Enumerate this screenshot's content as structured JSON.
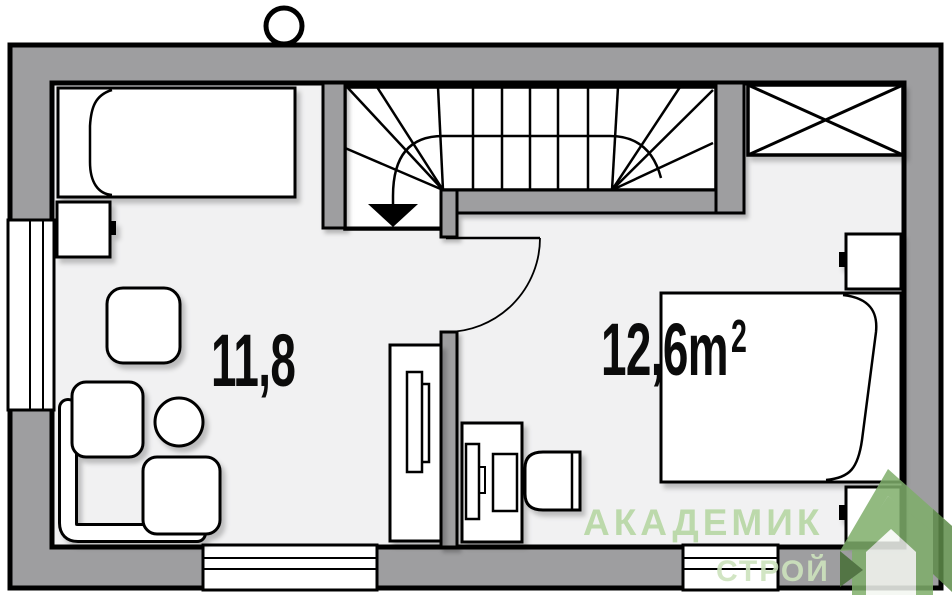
{
  "floor_plan": {
    "rooms": {
      "living": {
        "area_label": "11,8"
      },
      "bedroom": {
        "area_label": "12,6m²",
        "area_main": "12,6m",
        "area_sup": "2"
      }
    },
    "watermark": {
      "brand_line1": "АКАДЕМИК",
      "brand_line2": "СТРОЙ",
      "logo_icon": "house-logo"
    },
    "colors": {
      "wall_fill": "#9e9ea0",
      "floor_fill": "#f1f1f2",
      "outline": "#000000",
      "furniture_fill": "#ffffff",
      "watermark_text": "#b7d7a4",
      "watermark_text_light": "#cde3bd",
      "logo_green": "#7fae6b",
      "logo_green_dark": "#5e8c4a",
      "logo_green_deep": "#476f36",
      "logo_highlight": "#f4f7f1"
    }
  }
}
